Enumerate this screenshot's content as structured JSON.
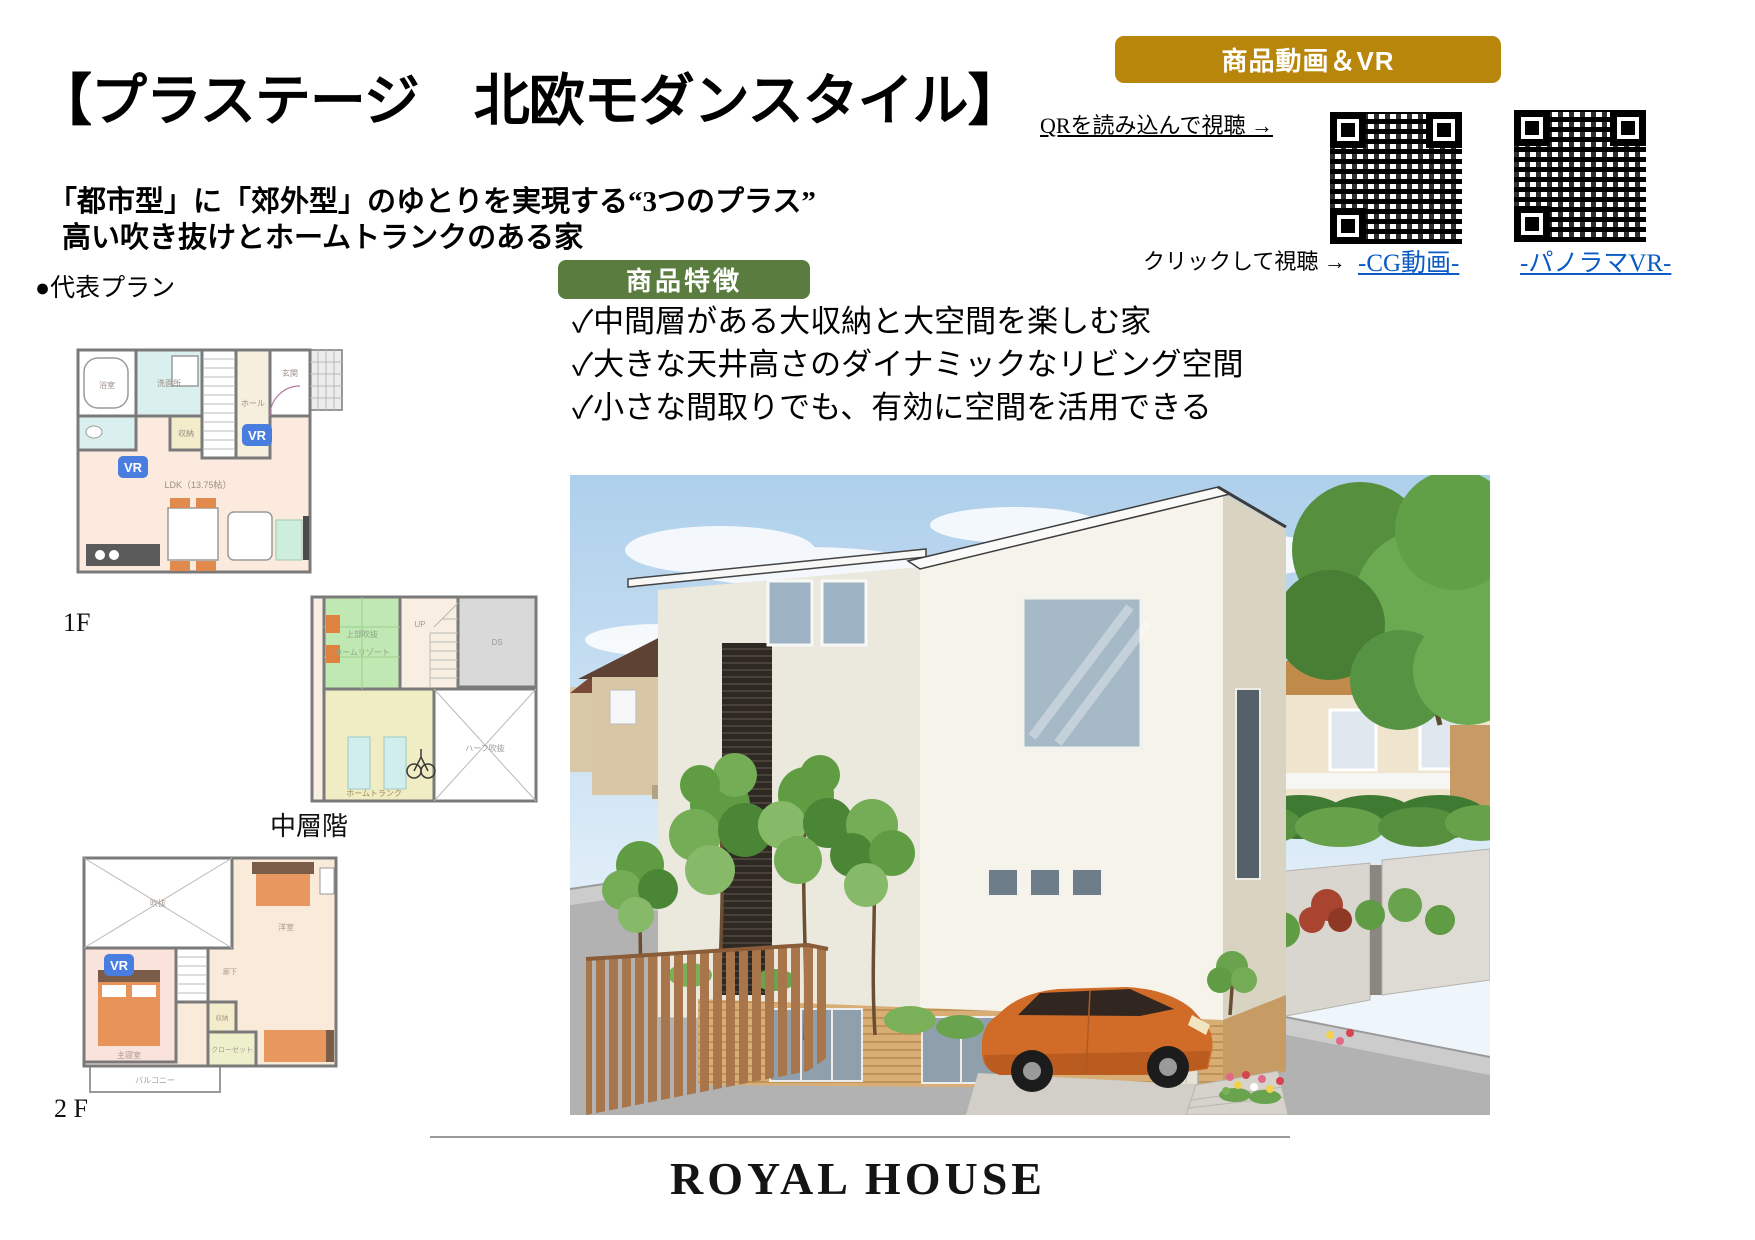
{
  "page": {
    "title": "【プラステージ　北欧モダンスタイル】",
    "subtitle1": "「都市型」に「郊外型」のゆとりを実現する“3つのプラス”",
    "subtitle2": "高い吹き抜けとホームトランクのある家"
  },
  "media": {
    "banner": "商品動画＆VR",
    "qr_caption": "QRを読み込んで視聴 →",
    "click_caption": "クリックして視聴 →",
    "link_cg": "-CG動画-",
    "link_vr": "-パノラマVR-",
    "accent_color": "#b8860b",
    "link_color": "#0b5bc4"
  },
  "features": {
    "banner": "商品特徴",
    "banner_color": "#5a7c3e",
    "item1": "✓中間層がある大収納と大空間を楽しむ家",
    "item2": "✓大きな天井高さのダイナミックなリビング空間",
    "item3": "✓小さな間取りでも、有効に空間を活用できる"
  },
  "plans": {
    "section_label": "●代表プラン",
    "vr_badge": "VR",
    "floor1": {
      "label": "1F",
      "rooms": {
        "bath": "浴室",
        "wash": "洗面所",
        "hall": "ホール",
        "entry": "玄関",
        "storage": "収納",
        "ldk": "LDK（13.75帖）"
      }
    },
    "middle": {
      "label": "中層階",
      "rooms": {
        "resort": "ホームリゾート",
        "void_note": "上部吹抜",
        "up": "UP",
        "ds": "DS",
        "trunk": "ホームトランク",
        "half_void": "ハーフ吹抜"
      }
    },
    "floor2": {
      "label": "2 F",
      "rooms": {
        "void": "吹抜",
        "bedroom": "主寝室",
        "corridor": "廊下",
        "storage": "収納",
        "closet": "クローゼット",
        "balcony": "バルコニー",
        "west": "洋室"
      }
    }
  },
  "footer": {
    "logo": "ROYAL HOUSE"
  }
}
